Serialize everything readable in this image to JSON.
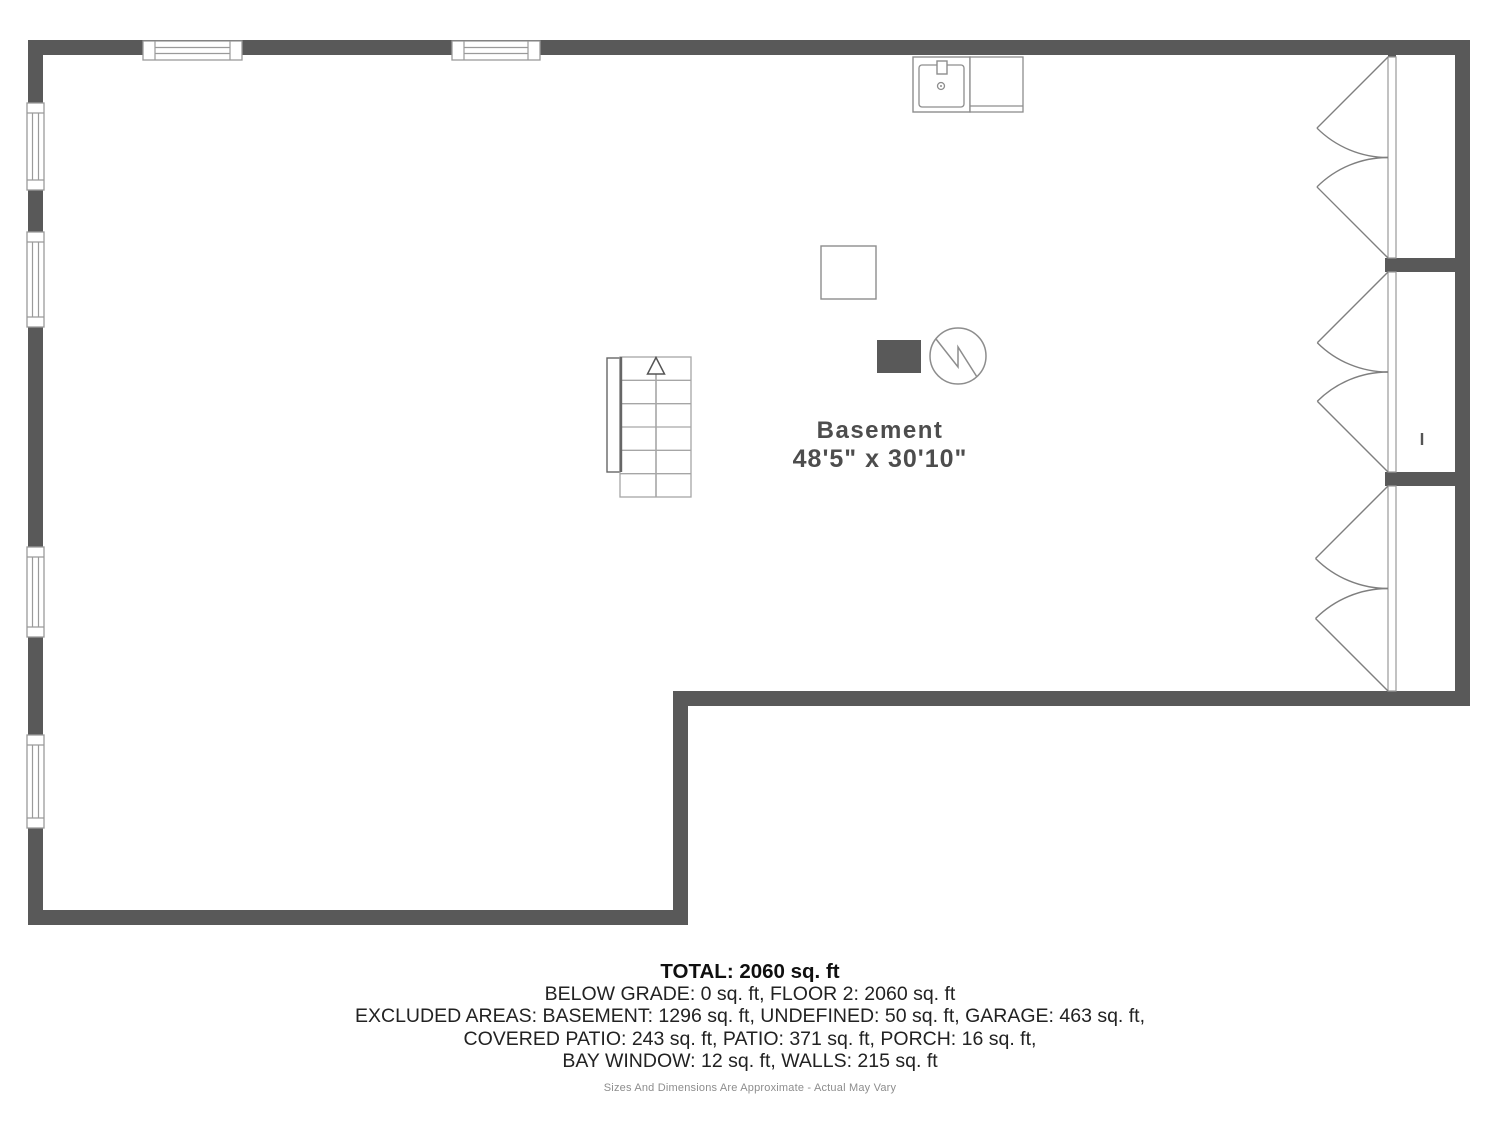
{
  "room": {
    "name": "Basement",
    "dims": "48'5\" x 30'10\""
  },
  "footer": {
    "total": "TOTAL: 2060 sq. ft",
    "lines": [
      "BELOW GRADE: 0 sq. ft, FLOOR 2: 2060 sq. ft",
      "EXCLUDED AREAS: BASEMENT: 1296 sq. ft, UNDEFINED: 50 sq. ft, GARAGE: 463 sq. ft,",
      "COVERED PATIO: 243 sq. ft, PATIO: 371 sq. ft, PORCH: 16 sq. ft,",
      "BAY WINDOW: 12 sq. ft, WALLS: 215 sq. ft"
    ],
    "disclaimer": "Sizes And Dimensions Are Approximate - Actual May Vary"
  },
  "colors": {
    "wall": "#595959",
    "fixture_line": "#8d8d8d",
    "window_line": "#9a9a9a",
    "stair_line": "#a6a6a6",
    "stair_edge": "#666666",
    "door_line": "#7f7f7f",
    "label": "#4d4d4d",
    "panel_fill": "#595959"
  },
  "geometry": {
    "walls": [
      {
        "x": 28,
        "y": 40,
        "w": 1442,
        "h": 15
      },
      {
        "x": 28,
        "y": 40,
        "w": 15,
        "h": 885
      },
      {
        "x": 1455,
        "y": 40,
        "w": 15,
        "h": 666
      },
      {
        "x": 673,
        "y": 691,
        "w": 797,
        "h": 15
      },
      {
        "x": 673,
        "y": 691,
        "w": 15,
        "h": 234
      },
      {
        "x": 28,
        "y": 910,
        "w": 660,
        "h": 15
      },
      {
        "x": 1385,
        "y": 258,
        "w": 70,
        "h": 14
      },
      {
        "x": 1385,
        "y": 472,
        "w": 70,
        "h": 14
      },
      {
        "x": 1388,
        "y": 55,
        "w": 8,
        "h": 5
      },
      {
        "x": 1388,
        "y": 686,
        "w": 8,
        "h": 5
      }
    ],
    "windows": [
      {
        "o": "h",
        "x": 143,
        "y": 41,
        "w": 99,
        "h": 19
      },
      {
        "o": "h",
        "x": 452,
        "y": 41,
        "w": 88,
        "h": 19
      },
      {
        "o": "v",
        "x": 27,
        "y": 103,
        "w": 17,
        "h": 87
      },
      {
        "o": "v",
        "x": 27,
        "y": 232,
        "w": 17,
        "h": 95
      },
      {
        "o": "v",
        "x": 27,
        "y": 547,
        "w": 17,
        "h": 90
      },
      {
        "o": "v",
        "x": 27,
        "y": 735,
        "w": 17,
        "h": 93
      }
    ],
    "door_strips": [
      {
        "x": 1388,
        "y": 57,
        "w": 8,
        "h": 201
      },
      {
        "x": 1388,
        "y": 272,
        "w": 8,
        "h": 200
      },
      {
        "x": 1388,
        "y": 486,
        "w": 8,
        "h": 205
      }
    ],
    "door_pairs": [
      {
        "hx": 1388,
        "y1": 57,
        "y2": 258
      },
      {
        "hx": 1388,
        "y1": 272,
        "y2": 472
      },
      {
        "hx": 1388,
        "y1": 486,
        "y2": 691
      }
    ],
    "stairs": {
      "rail": {
        "x": 607,
        "y": 358,
        "w": 13,
        "h": 114
      },
      "box": {
        "x": 620,
        "y": 357,
        "w": 71,
        "h": 140
      },
      "rows": 6,
      "cx": 656,
      "edge_bottom": 472,
      "arrow": {
        "tipY": 357.5,
        "baseY": 374,
        "halfW": 8.5
      }
    },
    "sink": {
      "box": {
        "x": 913,
        "y": 57,
        "w": 57,
        "h": 55
      },
      "inner": {
        "x": 919,
        "y": 65,
        "w": 45,
        "h": 42,
        "rx": 3
      },
      "faucet": {
        "x": 937,
        "y": 61,
        "w": 10,
        "h": 13
      },
      "drain": {
        "cx": 941,
        "cy": 86,
        "r": 3.5
      }
    },
    "counter": {
      "x": 970,
      "y": 57,
      "w": 53,
      "h": 55,
      "lineY": 106
    },
    "furnace": {
      "x": 821,
      "y": 246,
      "w": 55,
      "h": 53
    },
    "panel": {
      "x": 877,
      "y": 340,
      "w": 44,
      "h": 33
    },
    "water_heater": {
      "cx": 958,
      "cy": 356,
      "r": 28,
      "bolt": [
        [
          936,
          339
        ],
        [
          958,
          367
        ],
        [
          958,
          347
        ],
        [
          977,
          377
        ]
      ]
    },
    "tick": {
      "x1": 1422,
      "y1": 433,
      "x2": 1422,
      "y2": 445
    },
    "label_pos": {
      "name_x": 880,
      "name_y": 438,
      "dims_x": 880,
      "dims_y": 467
    }
  }
}
